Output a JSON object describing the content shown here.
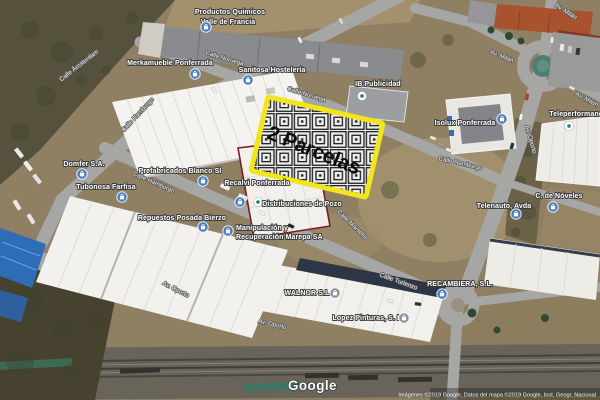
{
  "overlay": {
    "label": "2 Parcelas",
    "border_color": "#f2e51a",
    "hatch_dark": "#1e1e1e",
    "hatch_light": "#efefef",
    "partial_parcel_outline_color": "#7d1d1d"
  },
  "places": [
    {
      "name": "Productos Químicos",
      "name2": "Valle de Francia",
      "pin": "blue"
    },
    {
      "name": "Merkamueble Ponferrada",
      "pin": "blue"
    },
    {
      "name": "Sanitosa Hostelería",
      "pin": "blue"
    },
    {
      "name": "IB Publicidad",
      "pin": "white"
    },
    {
      "name": "Isolux Ponferrada",
      "pin": "blue"
    },
    {
      "name": "Teleperformance",
      "pin": "white"
    },
    {
      "name": "Domfer S.A.",
      "pin": "blue"
    },
    {
      "name": "Tubonosa Farfisa",
      "pin": "blue"
    },
    {
      "name": "Prefabricados Blanco Sl",
      "pin": "blue"
    },
    {
      "name": "Recalvi Ponferrada",
      "pin": "blue"
    },
    {
      "name": "Distribuciones de Pozo",
      "pin": "white"
    },
    {
      "name": "Repuestos Posada Bierzo",
      "pin": "blue"
    },
    {
      "name": "Manipulación y",
      "name2": "Recuperación Marepa SA",
      "pin": "blue"
    },
    {
      "name": "WALNOR S.L.",
      "pin": "gray"
    },
    {
      "name": "Lopez Pinturas, S. L.",
      "pin": "gray"
    },
    {
      "name": "RECAMBIERA, S.L.",
      "pin": "blue"
    },
    {
      "name": "Telenauto, Avda",
      "pin": "blue"
    },
    {
      "name": "C. de Nóveles",
      "pin": "blue"
    }
  ],
  "roads": [
    "Calle Ámsterdam",
    "Calle Hamburgo",
    "Calle Noruega",
    "Calle Noruega",
    "Calle Hamburgo",
    "Calle Marsella",
    "Calle Hamburgo",
    "Calle Turienzo",
    "Av. Oporto",
    "Av. Oporto",
    "Av. Oporto",
    "Av. Milán",
    "Av. Milán",
    "Av. Milán"
  ],
  "pin_colors": {
    "blue": "#4d7fc0",
    "gray": "#8d939e",
    "white_glyph": "#0d8680"
  },
  "logo": "Google",
  "attribution": "Imágenes ©2019 Google, Datos del mapa ©2019 Google, Inst. Geogr. Nacional"
}
